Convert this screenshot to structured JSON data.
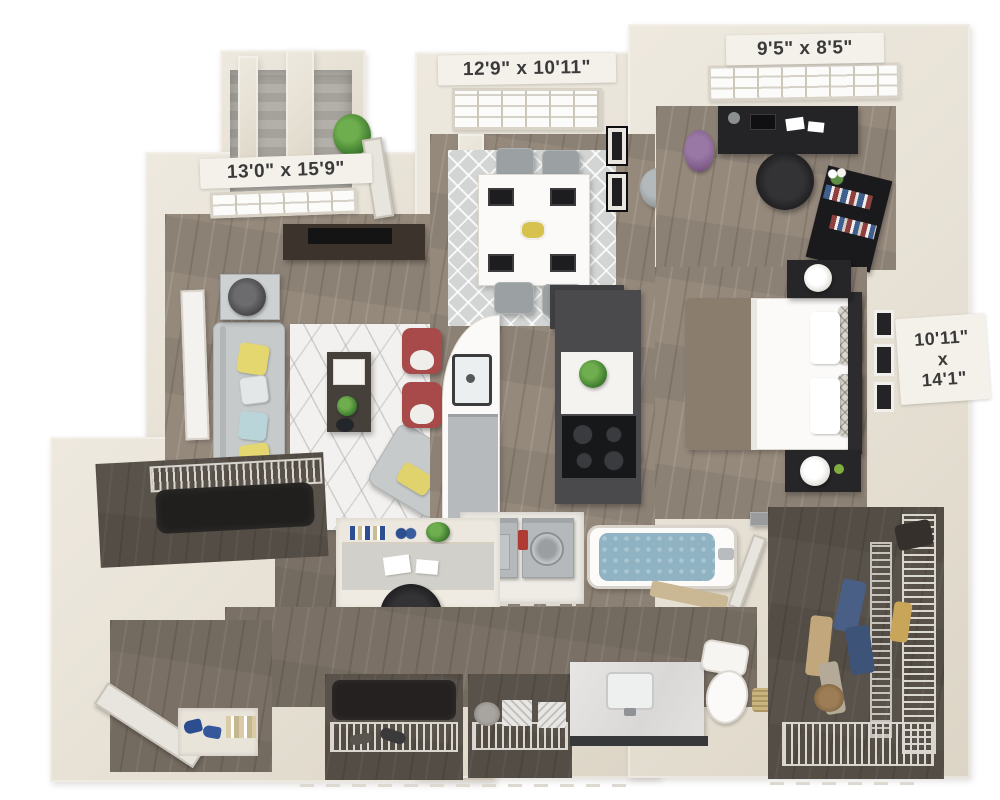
{
  "plan_type": "apartment-floor-plan-3d",
  "labels": {
    "living_room": "13'0\" x 15'9\"",
    "dining_room": "12'9\" x 10'11\"",
    "office": "9'5\" x 8'5\"",
    "bedroom_line1": "10'11\"",
    "bedroom_line2": "x",
    "bedroom_line3": "14'1\""
  },
  "palette": {
    "background": "#ffffff",
    "wall_cream": "#e8e2d7",
    "wood_floor": "#95897c",
    "wood_floor_dark": "#6b6157",
    "balcony_stone": "#aeaba4",
    "rug_white": "#f2f1ef",
    "rug_gray": "#d3d5d4",
    "sofa_gray": "#c6caca",
    "pillow_yellow": "#e4d76f",
    "pillow_blue": "#bad5d9",
    "stool_red": "#a84a49",
    "cabinet_dark": "#3c3c3e",
    "bed_blanket_taupe": "#8a7d6d",
    "tub_water_blue": "#8fb3c2",
    "label_bg": "#f4f1ea",
    "label_text": "#3a3a3a"
  }
}
